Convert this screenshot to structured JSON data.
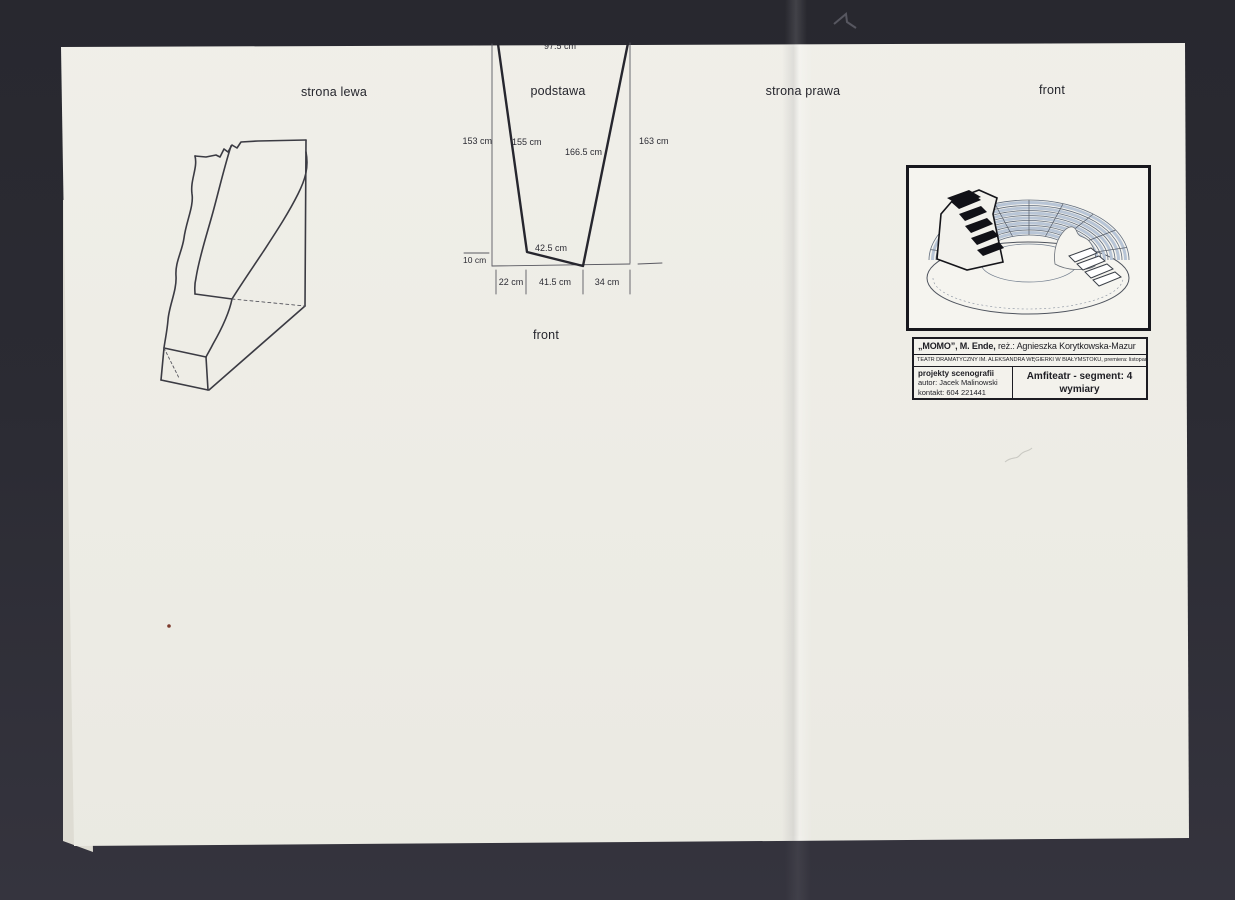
{
  "colors": {
    "background": "#2b2b33",
    "paper": "#edece5",
    "ink": "#2c2c34",
    "seating_blue": "#aab9cc",
    "speck_red": "#7c3a2c"
  },
  "labels": {
    "strona_lewa": "strona lewa",
    "podstawa": "podstawa",
    "strona_prawa": "strona prawa",
    "front_right": "front",
    "front_bottom": "front"
  },
  "podstawa_diagram": {
    "top_width": "97.5 cm",
    "left_outer": "153 cm",
    "left_edge": "155 cm",
    "right_edge": "166.5 cm",
    "right_outer": "163 cm",
    "bottom_edge": "42.5 cm",
    "left_offset": "10 cm",
    "bottom_segments": [
      "22 cm",
      "41.5 cm",
      "34 cm"
    ]
  },
  "title_block": {
    "row1_bold": "„MOMO”, M. Ende,",
    "row1_rest": " reż.: Agnieszka Korytkowska-Mazur",
    "row2": "TEATR DRAMATYCZNY IM. ALEKSANDRA WĘGIERKI W BIAŁYMSTOKU, premiera: listopad 2013",
    "left_line1": "projekty scenografii",
    "left_line2": "autor: Jacek Malinowski",
    "left_line3": "kontakt: 604 221441",
    "right_line1": "Amfiteatr - segment: 4",
    "right_line2": "wymiary"
  }
}
